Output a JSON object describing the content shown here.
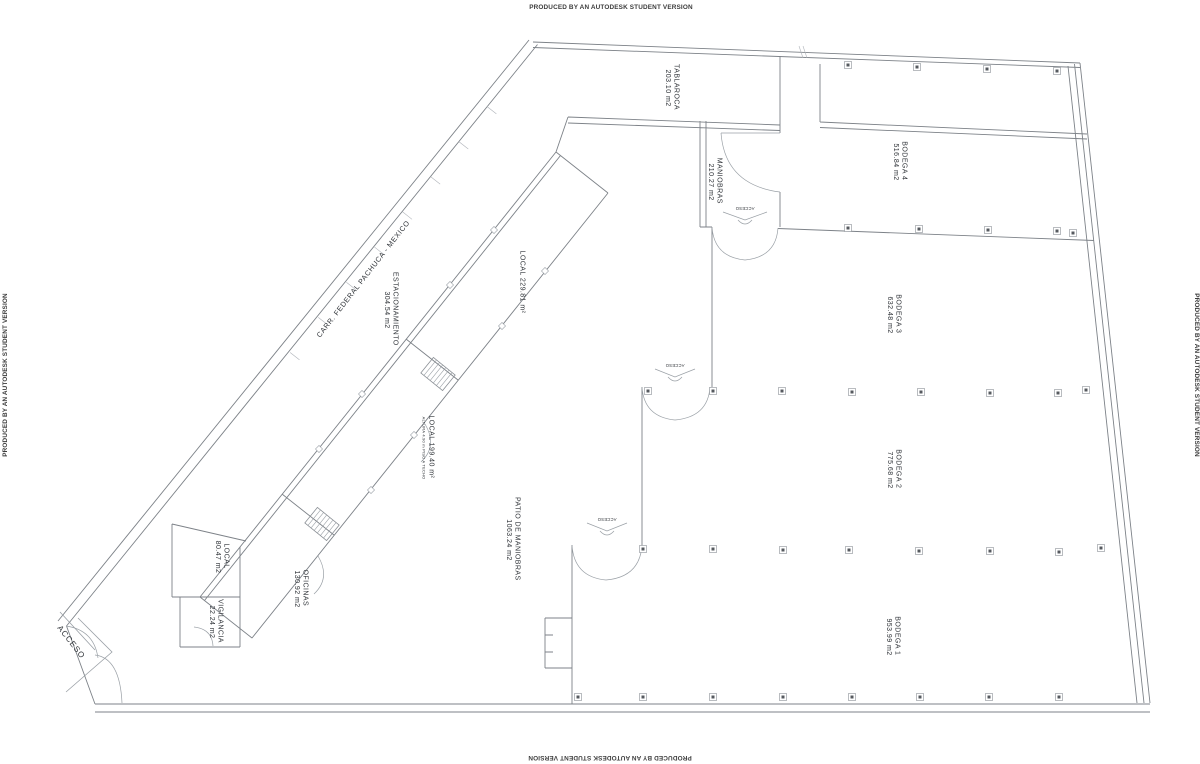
{
  "watermark": {
    "text": "PRODUCED BY AN AUTODESK STUDENT VERSION"
  },
  "rooms": {
    "tablaroca": {
      "name": "TABLAROCA",
      "area": "203.10 m2"
    },
    "maniobras": {
      "name": "MANIOBRAS",
      "area": "210.27 m2"
    },
    "bodega4": {
      "name": "BODEGA 4",
      "area": "516.84 m2"
    },
    "bodega3": {
      "name": "BODEGA 3",
      "area": "632.48 m2"
    },
    "bodega2": {
      "name": "BODEGA 2",
      "area": "775.68 m2"
    },
    "bodega1": {
      "name": "BODEGA 1",
      "area": "953.99 m2"
    },
    "local_229": {
      "name": "LOCAL 229.81 m²"
    },
    "local_199": {
      "name": "LOCAL 199.40 m²",
      "note": "ALTURA 4.90 m PISO A TECHO"
    },
    "estacionamiento": {
      "name": "ESTACIONAMIENTO",
      "area": "304.54 m2"
    },
    "patio": {
      "name": "PATIO DE MANIOBRAS",
      "area": "1063.24 m2"
    },
    "local_80": {
      "name": "LOCAL",
      "area": "80.47 m2"
    },
    "oficinas": {
      "name": "OFICINAS",
      "area": "130.92 m2"
    },
    "vigilancia": {
      "name": "VIGILANCIA",
      "area": "22.24 m2"
    }
  },
  "road": {
    "label": "CARR. FEDERAL PACHUCA - MEXICO"
  },
  "entrance": {
    "label": "ACCESO"
  },
  "doors": {
    "access_label": "ACCESO"
  },
  "colors": {
    "background": "#ffffff",
    "line": "#7d8288",
    "line_light": "#b0b4ba",
    "text": "#2f3338",
    "watermark": "#3c3c3c"
  }
}
